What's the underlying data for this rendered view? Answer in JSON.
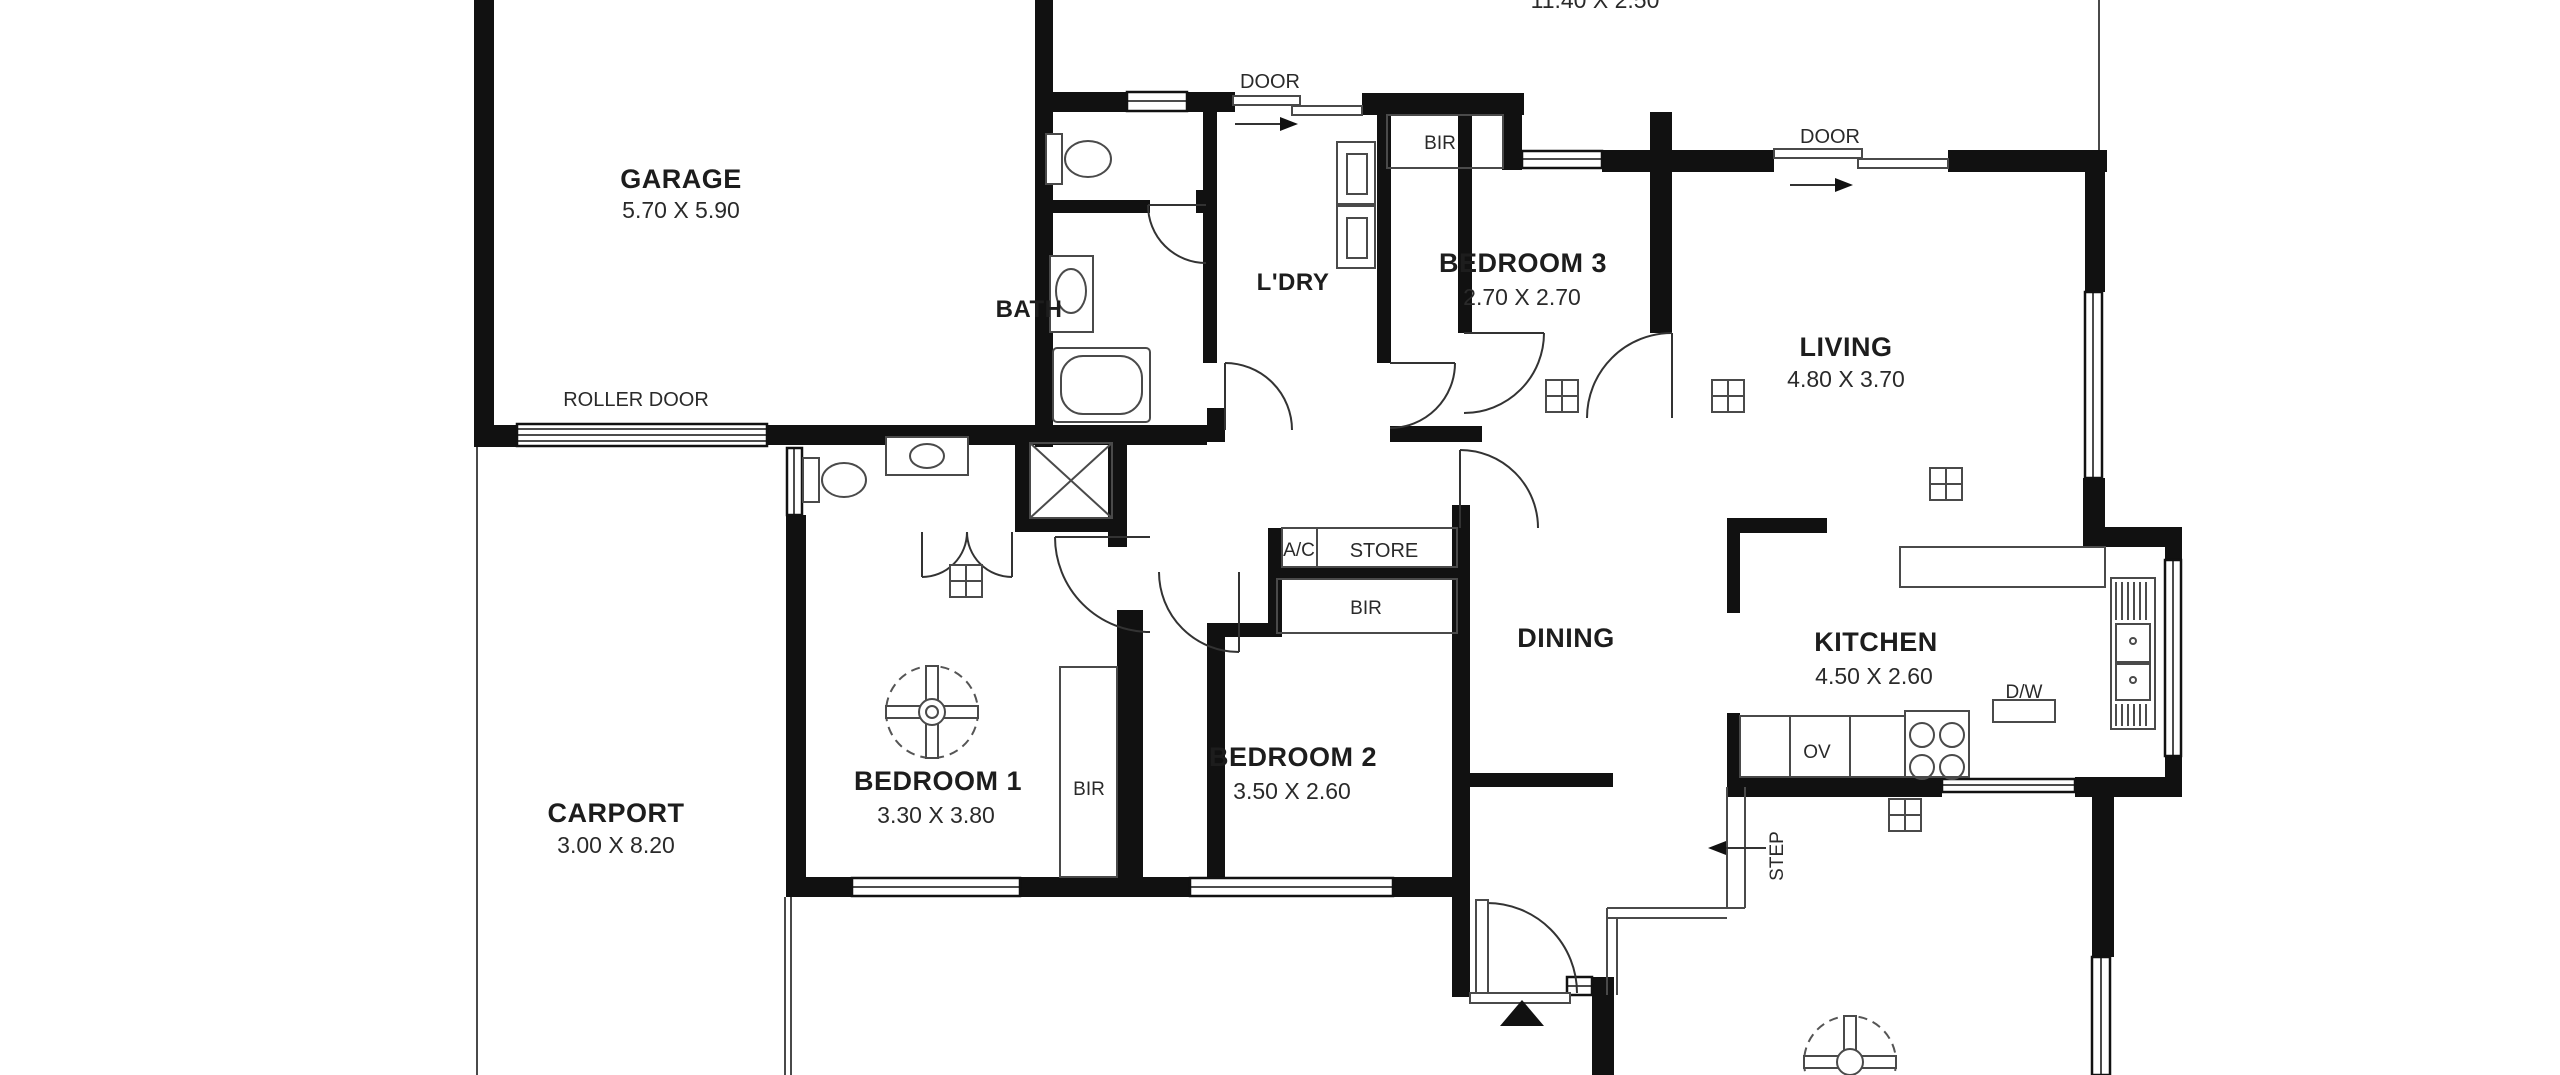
{
  "plan": {
    "title_partial_dim": "11.40 X 2.50",
    "rooms": {
      "garage": {
        "name": "GARAGE",
        "dims": "5.70 X 5.90"
      },
      "bath": {
        "name": "BATH",
        "dims": ""
      },
      "ldry": {
        "name": "L'DRY",
        "dims": ""
      },
      "bedroom3": {
        "name": "BEDROOM 3",
        "dims": "2.70 X 2.70"
      },
      "living": {
        "name": "LIVING",
        "dims": "4.80 X 3.70"
      },
      "dining": {
        "name": "DINING",
        "dims": ""
      },
      "kitchen": {
        "name": "KITCHEN",
        "dims": "4.50 X 2.60"
      },
      "bedroom2": {
        "name": "BEDROOM 2",
        "dims": "3.50 X 2.60"
      },
      "bedroom1": {
        "name": "BEDROOM 1",
        "dims": "3.30 X 3.80"
      },
      "carport": {
        "name": "CARPORT",
        "dims": "3.00 X 8.20"
      }
    },
    "annotations": {
      "roller_door": "ROLLER DOOR",
      "door_top": "DOOR",
      "door_living": "DOOR",
      "bir_bed3": "BIR",
      "bir_bed2": "BIR",
      "bir_bed1": "BIR",
      "ac": "A/C",
      "store": "STORE",
      "dw": "D/W",
      "ov": "OV",
      "step": "STEP"
    },
    "colors": {
      "wall": "#111111",
      "line": "#4a4a4a",
      "background": "#ffffff"
    }
  }
}
